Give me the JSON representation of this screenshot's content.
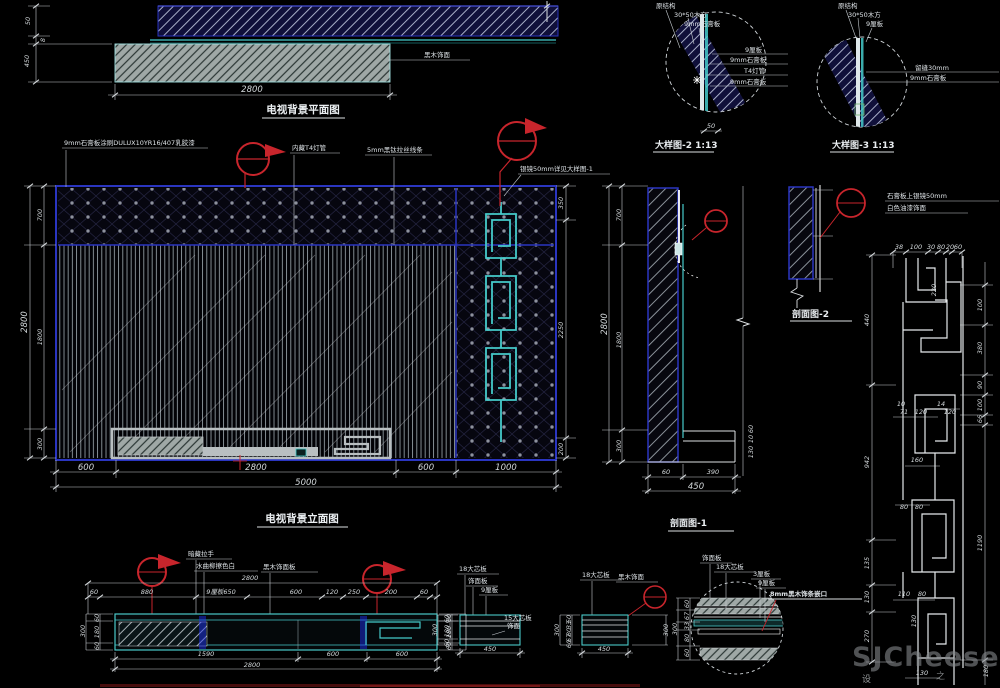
{
  "plan": {
    "title": "电视背景平面图",
    "w": "2800",
    "wall": "50",
    "depth": "450",
    "gap": "8",
    "note": "黑木饰面"
  },
  "elev": {
    "title": "电视背景立面图",
    "n1": "9mm石膏板涂刷DULUX10YR16/407乳胶漆",
    "n2": "内藏T4灯管",
    "n3": "5mm黑钛拉丝线条",
    "n4": "银镜50mm详见大样图-1",
    "lt": "2800",
    "l1": "700",
    "l2": "1800",
    "l3": "300",
    "r1": "350",
    "r2": "2250",
    "r3": "200",
    "b1": "600",
    "b2": "2800",
    "b3": "600",
    "b4": "1000",
    "bt": "5000"
  },
  "sec1": {
    "title": "剖面图-1",
    "lt": "2800",
    "l1": "700",
    "l2": "1800",
    "l3": "300",
    "b1": "60",
    "b2": "390",
    "bt": "450",
    "r1": "60",
    "r2": "10",
    "r3": "130"
  },
  "sec2": {
    "title": "剖面图-2"
  },
  "d2": {
    "title": "大样图-2 1:13",
    "t1": "原结构",
    "t2": "30*50木方",
    "t3": "9mm石膏板",
    "r1": "9厘板",
    "r2": "9mm石膏板",
    "r3": "T4灯管",
    "r4": "9mm石膏板",
    "dim": "50"
  },
  "d3": {
    "title": "大样图-3 1:13",
    "t1": "原结构",
    "t2": "30*50木方",
    "t3": "9厘板",
    "r1": "留缝30mm",
    "r2": "9mm石膏板"
  },
  "fret": {
    "note1": "石膏板上银镜50mm",
    "note2": "白色油漆饰面",
    "dims": [
      "38",
      "100",
      "30",
      "80",
      "20",
      "60",
      "220",
      "100",
      "380",
      "90",
      "100",
      "66",
      "10",
      "71",
      "120",
      "14",
      "120",
      "160",
      "80",
      "80",
      "440",
      "942",
      "135",
      "130",
      "270",
      "110",
      "80",
      "130",
      "1190",
      "130",
      "180"
    ]
  },
  "cab": {
    "n1": "暗藏拉手",
    "n2": "水曲柳擦色白",
    "n3": "黑木饰面板",
    "t": [
      "60",
      "880",
      "9厘板650",
      "600",
      "120",
      "250",
      "200",
      "60"
    ],
    "tt": "2800",
    "b": [
      "1590",
      "600",
      "600"
    ],
    "bt": "2800",
    "l": [
      "60",
      "180",
      "60"
    ],
    "lt": "300",
    "r": [
      "60",
      "180",
      "60"
    ],
    "rt": "300"
  },
  "boxa": {
    "n1": "18大芯板",
    "n2": "饰面板",
    "n3": "9厘板",
    "s1": "15大芯板",
    "s2": "饰面",
    "l": [
      "60",
      "180",
      "60"
    ],
    "lt": "300",
    "b": "450"
  },
  "boxb": {
    "n1": "18大芯板",
    "n2": "黑木饰面",
    "l": [
      "50",
      "33",
      "80",
      "67",
      "60"
    ],
    "lt": "300",
    "b": "450",
    "r": "300"
  },
  "dc": {
    "n1": "饰面板",
    "n2": "18大芯板",
    "n3": "3厘板",
    "n4": "9厘板",
    "n5": "8mm黑木饰条嵌口",
    "l": [
      "60",
      "67",
      "33",
      "80",
      "60"
    ],
    "lt": "300"
  },
  "wm": {
    "brand": "SJCheese",
    "s1": "设",
    "s2": "之"
  }
}
